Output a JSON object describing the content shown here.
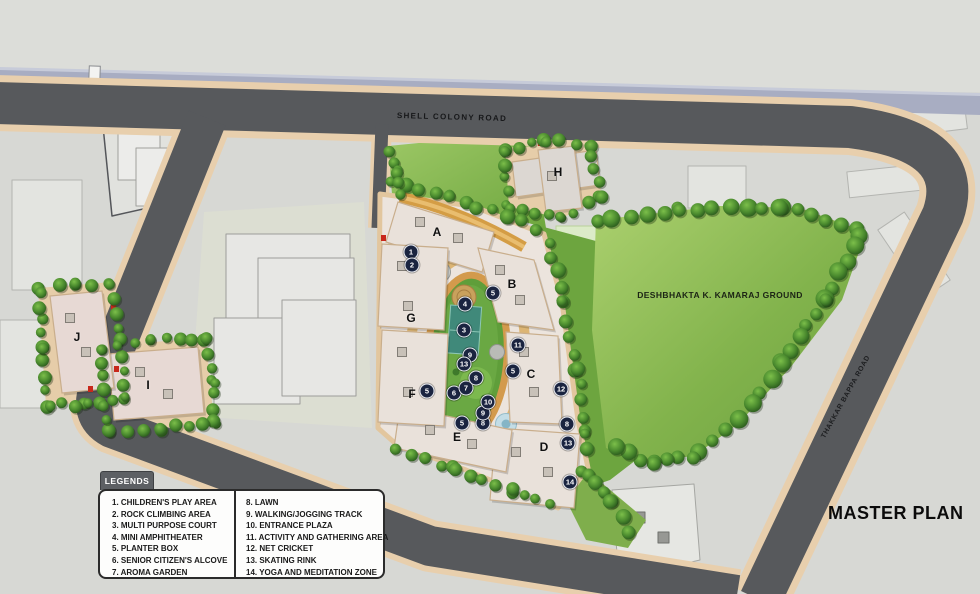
{
  "title": "MASTER PLAN",
  "roads": {
    "top_label": "SHELL COLONY ROAD",
    "right_label": "THAKKAR BAPPA ROAD"
  },
  "ground_label": "DESHBHAKTA K. KAMARAJ GROUND",
  "legend": {
    "title": "LEGENDS",
    "col1": [
      "1. CHILDREN'S PLAY AREA",
      "2. ROCK CLIMBING AREA",
      "3. MULTI PURPOSE COURT",
      "4. MINI AMPHITHEATER",
      "5. PLANTER BOX",
      "6. SENIOR CITIZEN'S ALCOVE",
      "7. AROMA GARDEN"
    ],
    "col2": [
      "8. LAWN",
      "9. WALKING/JOGGING TRACK",
      "10. ENTRANCE PLAZA",
      "11. ACTIVITY AND GATHERING AREA",
      "12. NET CRICKET",
      "13. SKATING RINK",
      "14. YOGA AND MEDITATION ZONE"
    ]
  },
  "buildings": [
    {
      "label": "A",
      "x": 437,
      "y": 232
    },
    {
      "label": "B",
      "x": 512,
      "y": 284
    },
    {
      "label": "C",
      "x": 531,
      "y": 374
    },
    {
      "label": "D",
      "x": 544,
      "y": 447
    },
    {
      "label": "E",
      "x": 457,
      "y": 437
    },
    {
      "label": "F",
      "x": 412,
      "y": 394
    },
    {
      "label": "G",
      "x": 411,
      "y": 318
    },
    {
      "label": "H",
      "x": 558,
      "y": 172
    },
    {
      "label": "I",
      "x": 148,
      "y": 385
    },
    {
      "label": "J",
      "x": 77,
      "y": 337
    }
  ],
  "markers": [
    {
      "n": "1",
      "x": 411,
      "y": 252
    },
    {
      "n": "2",
      "x": 412,
      "y": 265
    },
    {
      "n": "3",
      "x": 464,
      "y": 330
    },
    {
      "n": "4",
      "x": 465,
      "y": 304
    },
    {
      "n": "5",
      "x": 493,
      "y": 293
    },
    {
      "n": "5",
      "x": 513,
      "y": 371
    },
    {
      "n": "5",
      "x": 427,
      "y": 391
    },
    {
      "n": "5",
      "x": 462,
      "y": 423
    },
    {
      "n": "6",
      "x": 454,
      "y": 393
    },
    {
      "n": "7",
      "x": 466,
      "y": 388
    },
    {
      "n": "8",
      "x": 476,
      "y": 378
    },
    {
      "n": "8",
      "x": 483,
      "y": 423
    },
    {
      "n": "8",
      "x": 567,
      "y": 424
    },
    {
      "n": "9",
      "x": 470,
      "y": 355
    },
    {
      "n": "9",
      "x": 483,
      "y": 413
    },
    {
      "n": "10",
      "x": 488,
      "y": 402
    },
    {
      "n": "11",
      "x": 518,
      "y": 345
    },
    {
      "n": "12",
      "x": 561,
      "y": 389
    },
    {
      "n": "13",
      "x": 464,
      "y": 364
    },
    {
      "n": "13",
      "x": 568,
      "y": 443
    },
    {
      "n": "14",
      "x": 570,
      "y": 482
    }
  ],
  "colors": {
    "marker_bg": "#1a2440",
    "road": "#57595c",
    "sidewalk_tan": "#e8cfad",
    "ground_green": "#7daf49",
    "accent_red": "#c8271b"
  }
}
